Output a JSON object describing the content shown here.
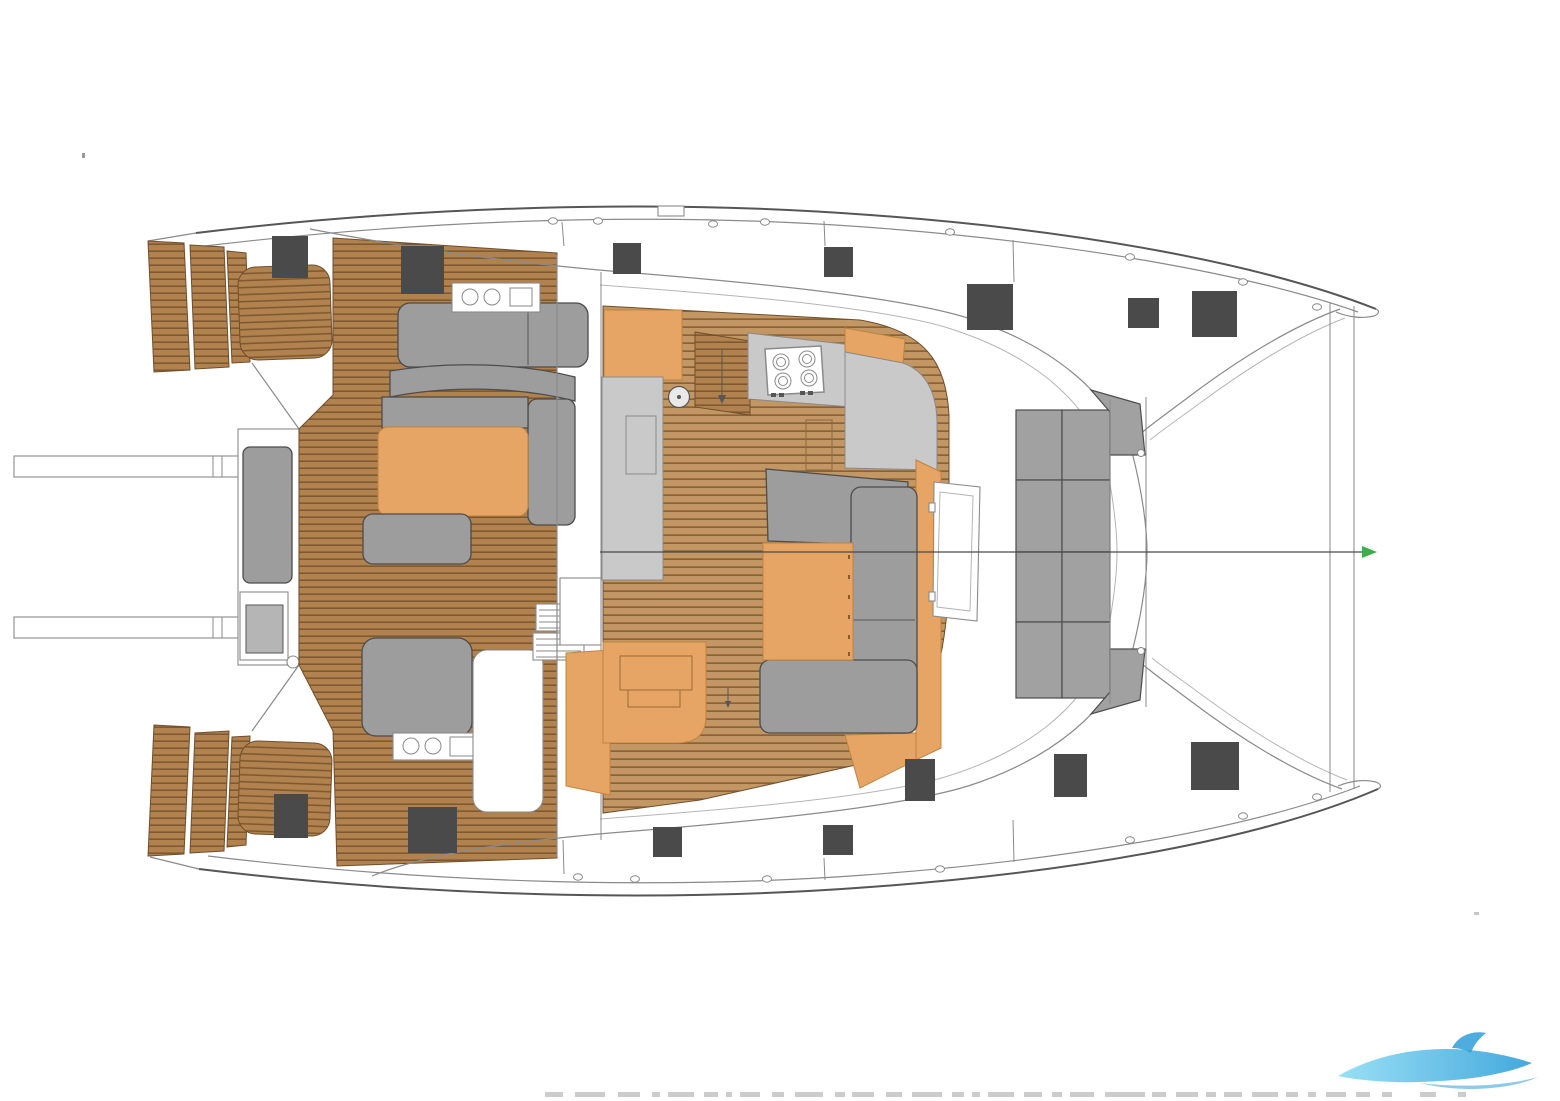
{
  "document": {
    "type": "technical-drawing",
    "subject": "catamaran-deck-and-saloon-floor-plan-top-view",
    "background": "#ffffff"
  },
  "palette": {
    "teak": "#b2824e",
    "teak_line": "#7e5a33",
    "teak_light": "#c29764",
    "teak_light_line": "#8a6239",
    "teak_stroke": "#6f4e2c",
    "orange": "#e7a565",
    "orange_stroke": "#bf8440",
    "seat_gray": "#9d9d9d",
    "seat_stroke": "#4c4c4c",
    "counter_gray": "#c9c9c9",
    "cushion_gray": "#a1a1a1",
    "hatch_dark": "#4a4a4a",
    "line": "#8a8a8a",
    "line_dark": "#565656",
    "line_faint": "#b5b5b5",
    "centerline": "#4a4a4a",
    "marker_green": "#3fae49",
    "logo_blue_light": "#8fdcf5",
    "logo_blue_deep": "#2f9fd8",
    "footer_mark": "#c4c4c4"
  },
  "deck_hatches": [
    {
      "x": 272,
      "y": 236,
      "w": 36,
      "h": 42
    },
    {
      "x": 401,
      "y": 246,
      "w": 43,
      "h": 48
    },
    {
      "x": 613,
      "y": 243,
      "w": 28,
      "h": 31
    },
    {
      "x": 824,
      "y": 247,
      "w": 29,
      "h": 30
    },
    {
      "x": 967,
      "y": 284,
      "w": 46,
      "h": 46
    },
    {
      "x": 1128,
      "y": 298,
      "w": 31,
      "h": 30
    },
    {
      "x": 1192,
      "y": 291,
      "w": 45,
      "h": 46
    },
    {
      "x": 274,
      "y": 794,
      "w": 34,
      "h": 44
    },
    {
      "x": 408,
      "y": 807,
      "w": 49,
      "h": 46
    },
    {
      "x": 653,
      "y": 827,
      "w": 29,
      "h": 30
    },
    {
      "x": 823,
      "y": 825,
      "w": 30,
      "h": 30
    },
    {
      "x": 905,
      "y": 759,
      "w": 30,
      "h": 42
    },
    {
      "x": 1054,
      "y": 754,
      "w": 33,
      "h": 43
    },
    {
      "x": 1191,
      "y": 742,
      "w": 48,
      "h": 48
    }
  ],
  "cleats": [
    {
      "x": 553,
      "y": 221
    },
    {
      "x": 598,
      "y": 221
    },
    {
      "x": 713,
      "y": 224
    },
    {
      "x": 765,
      "y": 222
    },
    {
      "x": 950,
      "y": 232
    },
    {
      "x": 1130,
      "y": 257
    },
    {
      "x": 1243,
      "y": 282
    },
    {
      "x": 1317,
      "y": 307
    },
    {
      "x": 578,
      "y": 877
    },
    {
      "x": 635,
      "y": 879
    },
    {
      "x": 767,
      "y": 879
    },
    {
      "x": 940,
      "y": 869
    },
    {
      "x": 1130,
      "y": 840
    },
    {
      "x": 1243,
      "y": 816
    },
    {
      "x": 1317,
      "y": 797
    }
  ],
  "forward_cockpit_cushions": {
    "cols": [
      1016,
      1062,
      1110
    ],
    "rows": [
      410,
      480,
      552,
      622,
      698
    ]
  },
  "centerline": {
    "x1": 600,
    "x2": 1362,
    "y": 552
  },
  "galley": {
    "burner_count": 4,
    "round_sink_count": 1,
    "double_basin_units": 2
  },
  "footer_marks": [
    [
      545,
      18
    ],
    [
      575,
      30
    ],
    [
      618,
      22
    ],
    [
      652,
      8
    ],
    [
      668,
      26
    ],
    [
      704,
      14
    ],
    [
      726,
      6
    ],
    [
      740,
      20
    ],
    [
      772,
      12
    ],
    [
      795,
      28
    ],
    [
      835,
      10
    ],
    [
      852,
      22
    ],
    [
      886,
      16
    ],
    [
      912,
      30
    ],
    [
      952,
      12
    ],
    [
      972,
      8
    ],
    [
      988,
      26
    ],
    [
      1024,
      18
    ],
    [
      1052,
      10
    ],
    [
      1070,
      24
    ],
    [
      1105,
      40
    ],
    [
      1152,
      14
    ],
    [
      1176,
      22
    ],
    [
      1206,
      10
    ],
    [
      1224,
      18
    ],
    [
      1252,
      26
    ],
    [
      1286,
      12
    ],
    [
      1308,
      8
    ],
    [
      1326,
      20
    ],
    [
      1356,
      14
    ],
    [
      1382,
      10
    ],
    [
      1420,
      16
    ],
    [
      1458,
      8
    ]
  ],
  "watermark": {
    "shape": "wave-swoosh",
    "position": "bottom-right"
  }
}
